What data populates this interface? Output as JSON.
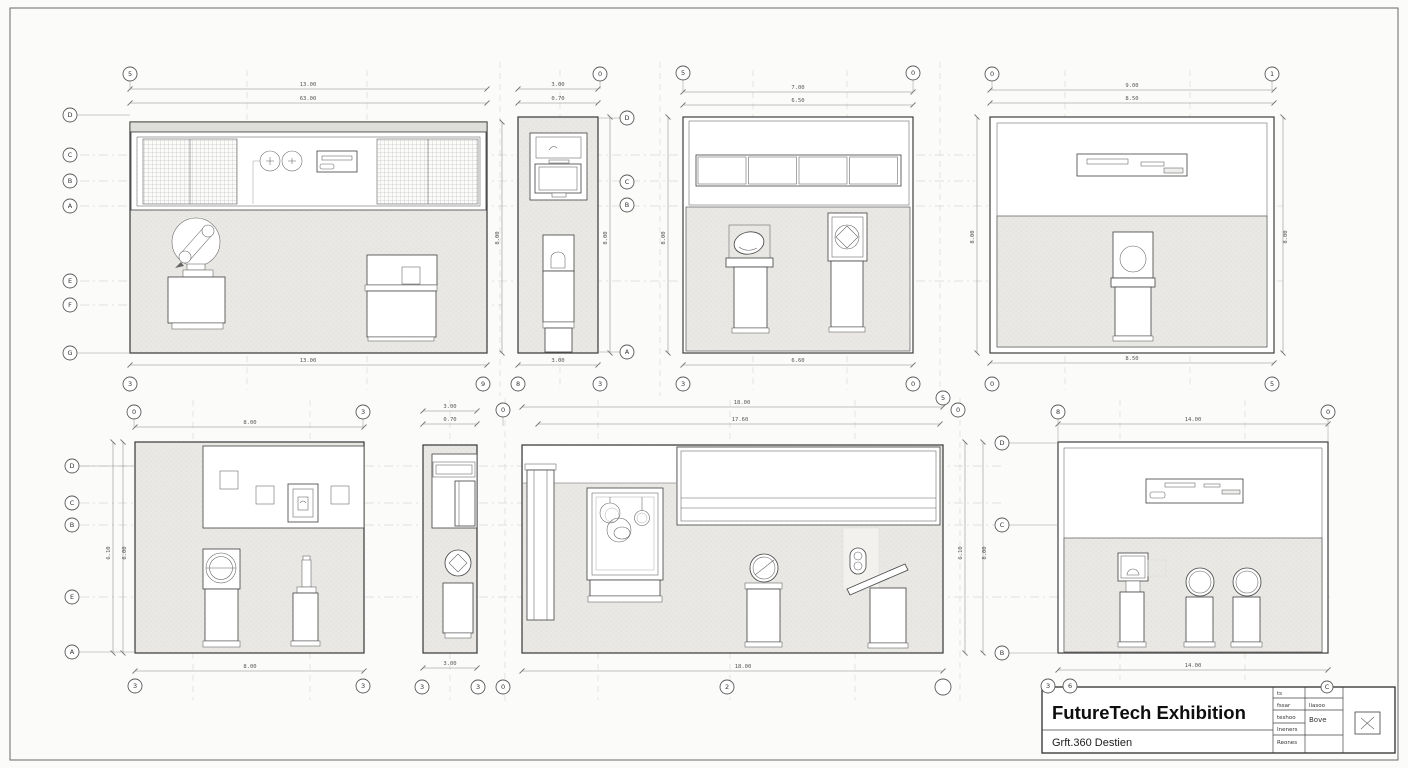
{
  "sheet": {
    "background": "#fbfbf9",
    "line_color": "#3e3e3e",
    "dim_color": "#888888",
    "panel_fill": "#e9e8e4",
    "hatch_color": "#a8a8a6",
    "centerline_color": "#c8c7c3"
  },
  "title_block": {
    "title": "FutureTech Exhibition",
    "subtitle": "Grft.360 Destien",
    "table": {
      "r1c1": "ts",
      "r2c1": "fssar",
      "r2c2": "liasoo",
      "r3c1": "teshoo",
      "r3c2": "Bove",
      "r4c1": "Ineners",
      "r5c1": "Reones"
    }
  },
  "panels": {
    "a": {
      "dims": {
        "t1": "13.00",
        "t2": "63.00",
        "b": "13.00",
        "s1": "8.00"
      },
      "top": [
        "5"
      ],
      "bottom": [
        "3",
        "9"
      ],
      "left": [
        "D",
        "C",
        "B",
        "A",
        "E",
        "F",
        "G"
      ]
    },
    "b": {
      "dims": {
        "t1": "3.00",
        "t2": "0.70",
        "b": "3.00",
        "s1": "8.00",
        "s2": "8.00"
      },
      "top": [
        "0"
      ],
      "bottom": [
        "8",
        "3"
      ],
      "right": [
        "D",
        "C",
        "B",
        "A"
      ]
    },
    "c": {
      "dims": {
        "t1": "7.00",
        "t2": "6.50",
        "b": "6.60"
      },
      "top": [
        "5",
        "0"
      ],
      "bottom": [
        "3",
        "0"
      ]
    },
    "d": {
      "dims": {
        "t1": "9.00",
        "t2": "8.50",
        "b": "8.50",
        "s1": "8.00",
        "s2": "8.00"
      },
      "top": [
        "0",
        "1"
      ],
      "bottom": [
        "0",
        "5"
      ]
    },
    "e": {
      "dims": {
        "t1": "8.00",
        "b": "8.00",
        "s1": "6.10",
        "s2": "6.00"
      },
      "top": [
        "0",
        "3"
      ],
      "bottom": [
        "3",
        "3"
      ],
      "left": [
        "D",
        "C",
        "B",
        "E",
        "A"
      ]
    },
    "f": {
      "dims": {
        "t1": "3.00",
        "t2": "0.70",
        "b": "3.00"
      },
      "top": [
        "0"
      ],
      "bottom": [
        "3",
        "3",
        "0"
      ]
    },
    "g": {
      "dims": {
        "t1": "18.00",
        "t2": "17.60",
        "b": "18.00",
        "s1": "6.10",
        "s2": "8.00"
      },
      "top": [
        "5",
        "0"
      ],
      "bottom": [
        "2"
      ]
    },
    "h": {
      "dims": {
        "t1": "14.00",
        "b": "14.00"
      },
      "top": [
        "8",
        "0"
      ],
      "bottom": [
        "3",
        "6",
        "C"
      ],
      "left": [
        "D",
        "C",
        "B"
      ]
    }
  }
}
